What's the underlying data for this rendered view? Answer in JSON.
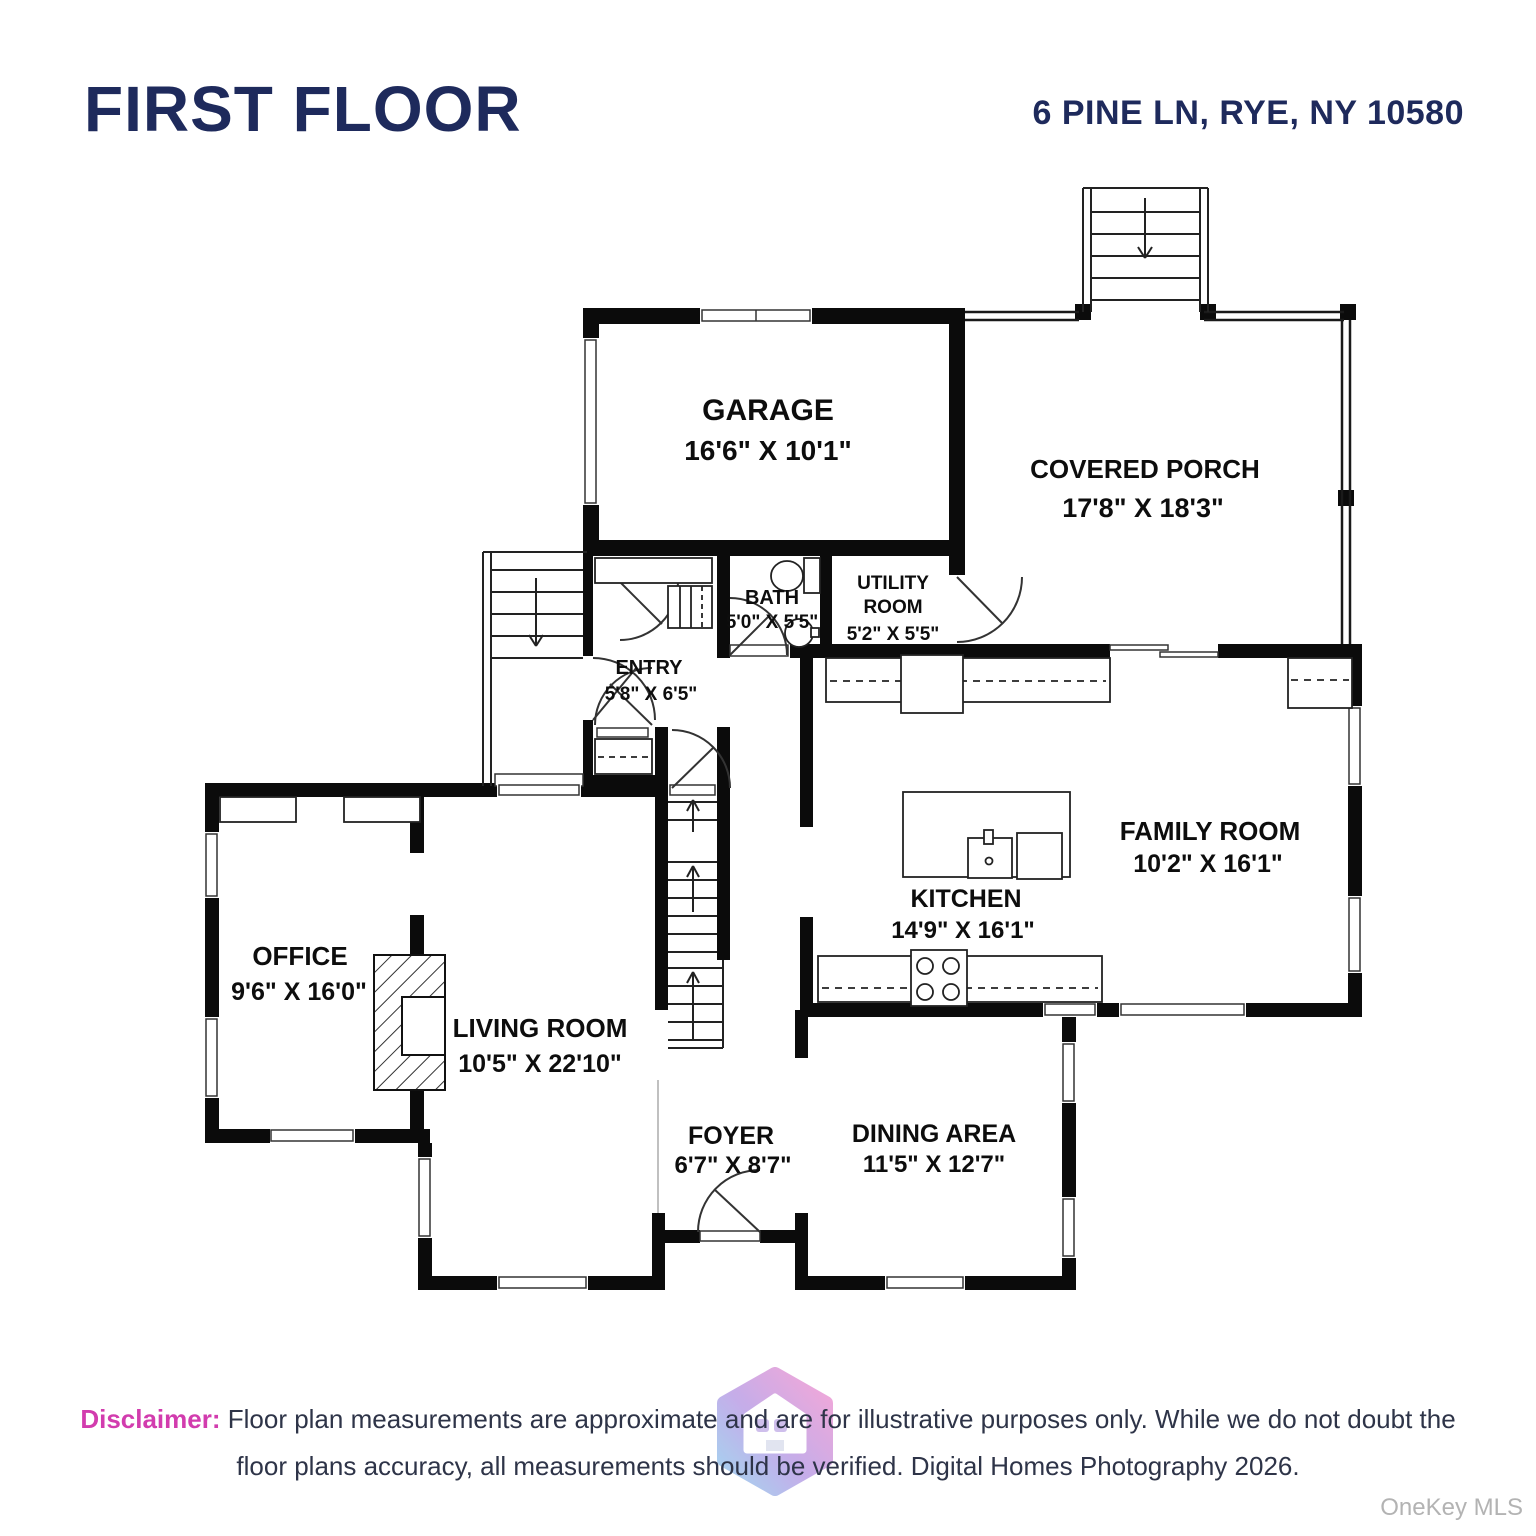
{
  "header": {
    "title": "FIRST FLOOR",
    "address": "6 PINE LN, RYE, NY 10580"
  },
  "rooms": [
    {
      "name": "GARAGE",
      "dims": "16'6\" X 10'1\""
    },
    {
      "name": "COVERED PORCH",
      "dims": "17'8\" X 18'3\""
    },
    {
      "name1": "UTILITY",
      "name2": "ROOM",
      "dims": "5'2\" X 5'5\""
    },
    {
      "name": "BATH",
      "dims": "5'0\" X 5'5\""
    },
    {
      "name": "ENTRY",
      "dims": "5'8\" X 6'5\""
    },
    {
      "name": "OFFICE",
      "dims": "9'6\" X 16'0\""
    },
    {
      "name": "LIVING ROOM",
      "dims": "10'5\" X 22'10\""
    },
    {
      "name": "KITCHEN",
      "dims": "14'9\" X 16'1\""
    },
    {
      "name": "FAMILY ROOM",
      "dims": "10'2\" X 16'1\""
    },
    {
      "name": "FOYER",
      "dims": "6'7\" X 8'7\""
    },
    {
      "name": "DINING AREA",
      "dims": "11'5\" X 12'7\""
    }
  ],
  "disclaimer": {
    "label": "Disclaimer:",
    "line1": "Floor plan measurements are approximate and are for illustrative purposes only. While we do not doubt the",
    "line2": "floor plans accuracy, all measurements should be verified. Digital Homes Photography 2026."
  },
  "watermark": "OneKey MLS",
  "colors": {
    "title_navy": "#1e2a5c",
    "disclaimer_pink": "#d23cae",
    "body_text": "#2e3448",
    "watermark_gray": "#b3b3b3",
    "wall_black": "#0b0b0b",
    "logo_pink": "#f3a3d7",
    "logo_purple": "#c2a9e8",
    "logo_blue": "#9fd3f0"
  }
}
